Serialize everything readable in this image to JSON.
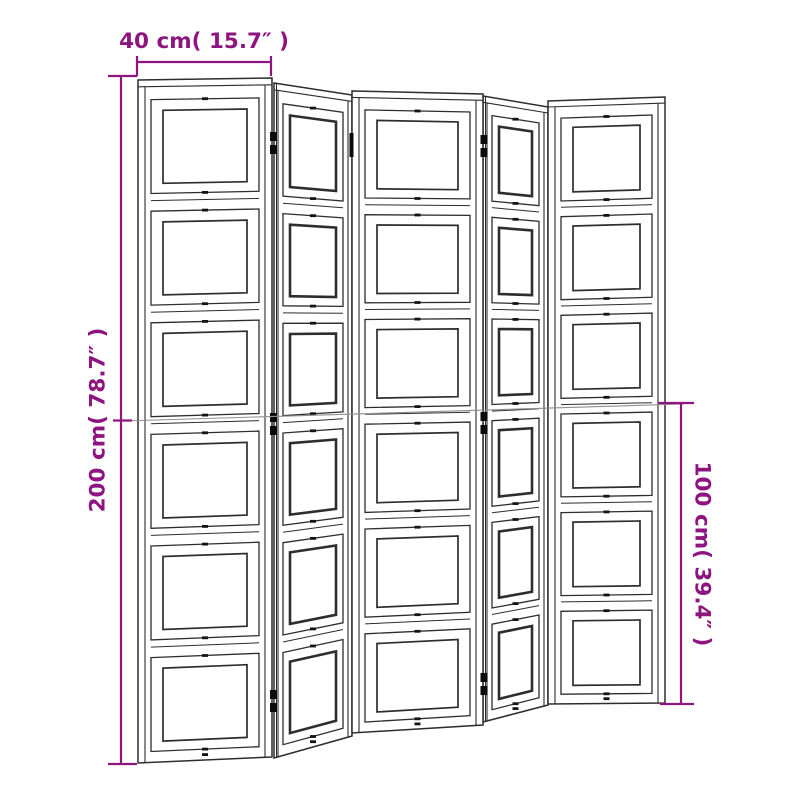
{
  "diagram": {
    "description": "Technical line drawing of a five-panel folding room divider screen, front view with slight perspective",
    "panel_count": 5,
    "sections_per_panel": 6,
    "line_color": "#2d2d2d",
    "dot_color": "#141414",
    "hinge_color": "#0b0b0b",
    "guide_line_color": "#8f8f8f",
    "background_color": "#ffffff"
  },
  "dimensions": {
    "accent_color": "#8e1480",
    "top": {
      "label": "40 cm( 15.7″ )"
    },
    "left": {
      "label": "200 cm( 78.7″ )"
    },
    "right": {
      "label": "100 cm( 39.4″ )"
    }
  }
}
